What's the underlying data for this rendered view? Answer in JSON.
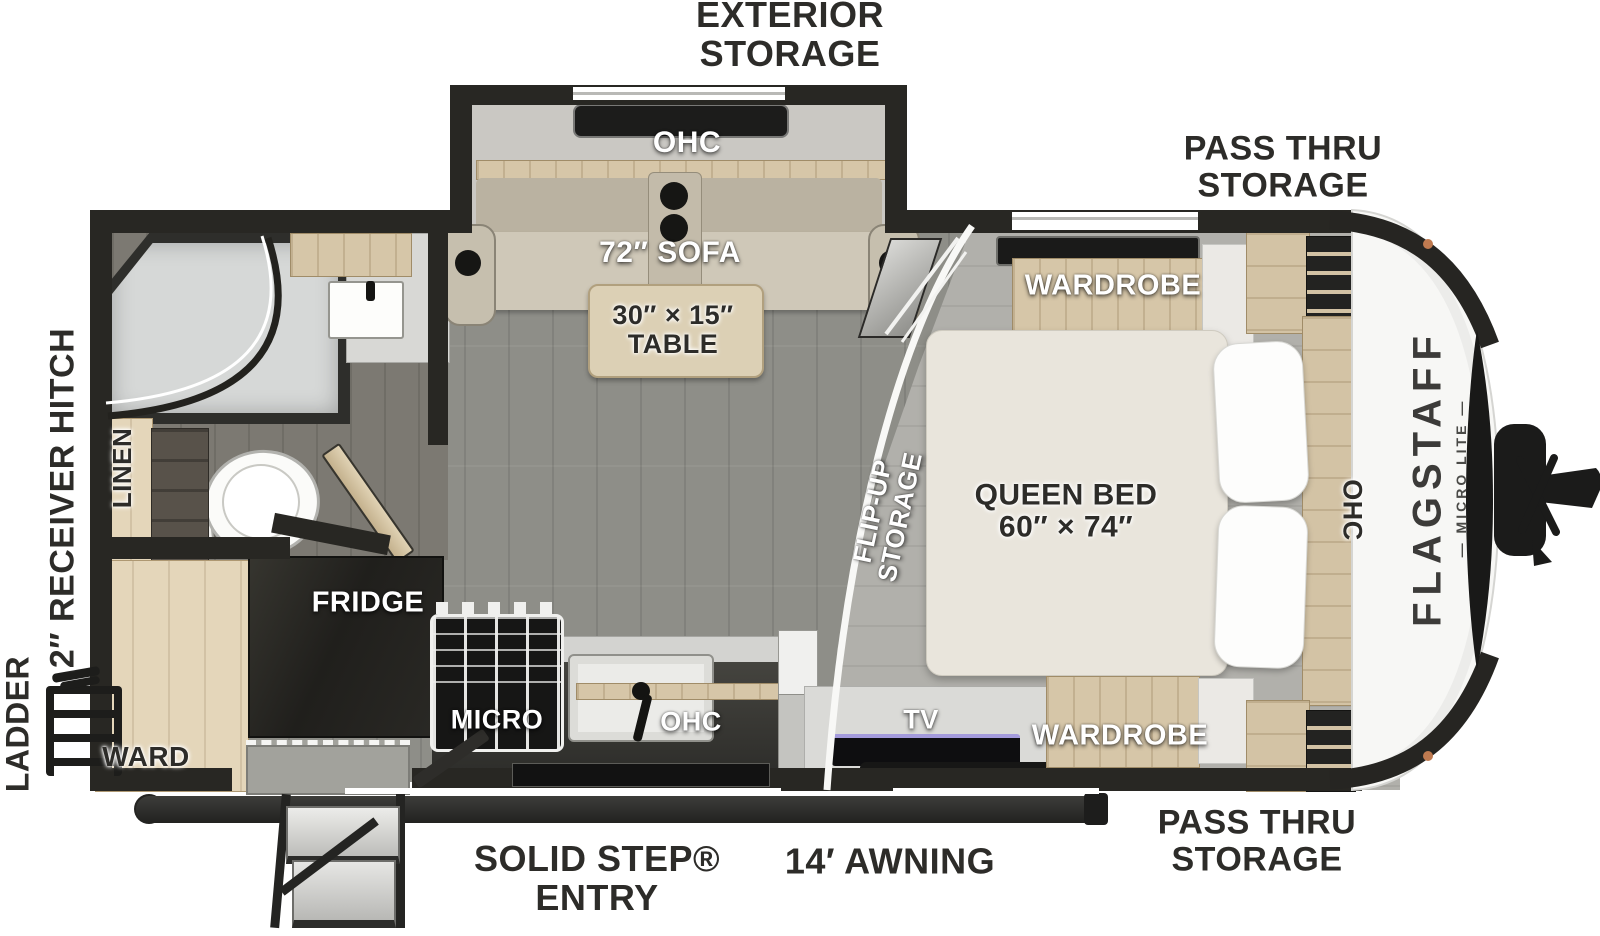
{
  "brand": {
    "name": "FLAGSTAFF",
    "tagline": "— MICRO LITE —"
  },
  "exterior_labels": {
    "exterior_storage": [
      "EXTERIOR",
      "STORAGE"
    ],
    "pass_thru_top": [
      "PASS THRU",
      "STORAGE"
    ],
    "pass_thru_bottom": [
      "PASS THRU",
      "STORAGE"
    ],
    "solid_step_entry": [
      "SOLID STEP®",
      "ENTRY"
    ],
    "awning": "14′ AWNING",
    "ladder": "LADDER",
    "receiver_hitch": "2″ RECEIVER HITCH"
  },
  "interior_labels": {
    "sofa_ohc": "OHC",
    "sofa": "72″ SOFA",
    "table": [
      "30″ × 15″",
      "TABLE"
    ],
    "wardrobe_top": "WARDROBE",
    "wardrobe_bottom": "WARDROBE",
    "queen_bed": [
      "QUEEN BED",
      "60″ × 74″"
    ],
    "flip_up": [
      "FLIP-UP",
      "STORAGE"
    ],
    "bed_ohc": "OHC",
    "fridge": "FRIDGE",
    "micro": "MICRO",
    "kitchen_ohc": "OHC",
    "tv": "TV",
    "linen": "LINEN",
    "ward": "WARD"
  },
  "colors": {
    "wall": "#282723",
    "wood_cabinet": "#d6c6a8",
    "floor_living": "#8e8e88",
    "floor_bedroom": "#b1b0ab",
    "floor_bath": "#7c7972",
    "sofa": "#cdc6b6",
    "bed": "#e9e5dc",
    "counter": "#383835",
    "front_cap": "#f7f7f5",
    "tv_accent": "#a49bdc",
    "brand_text": "#3c3b39"
  }
}
